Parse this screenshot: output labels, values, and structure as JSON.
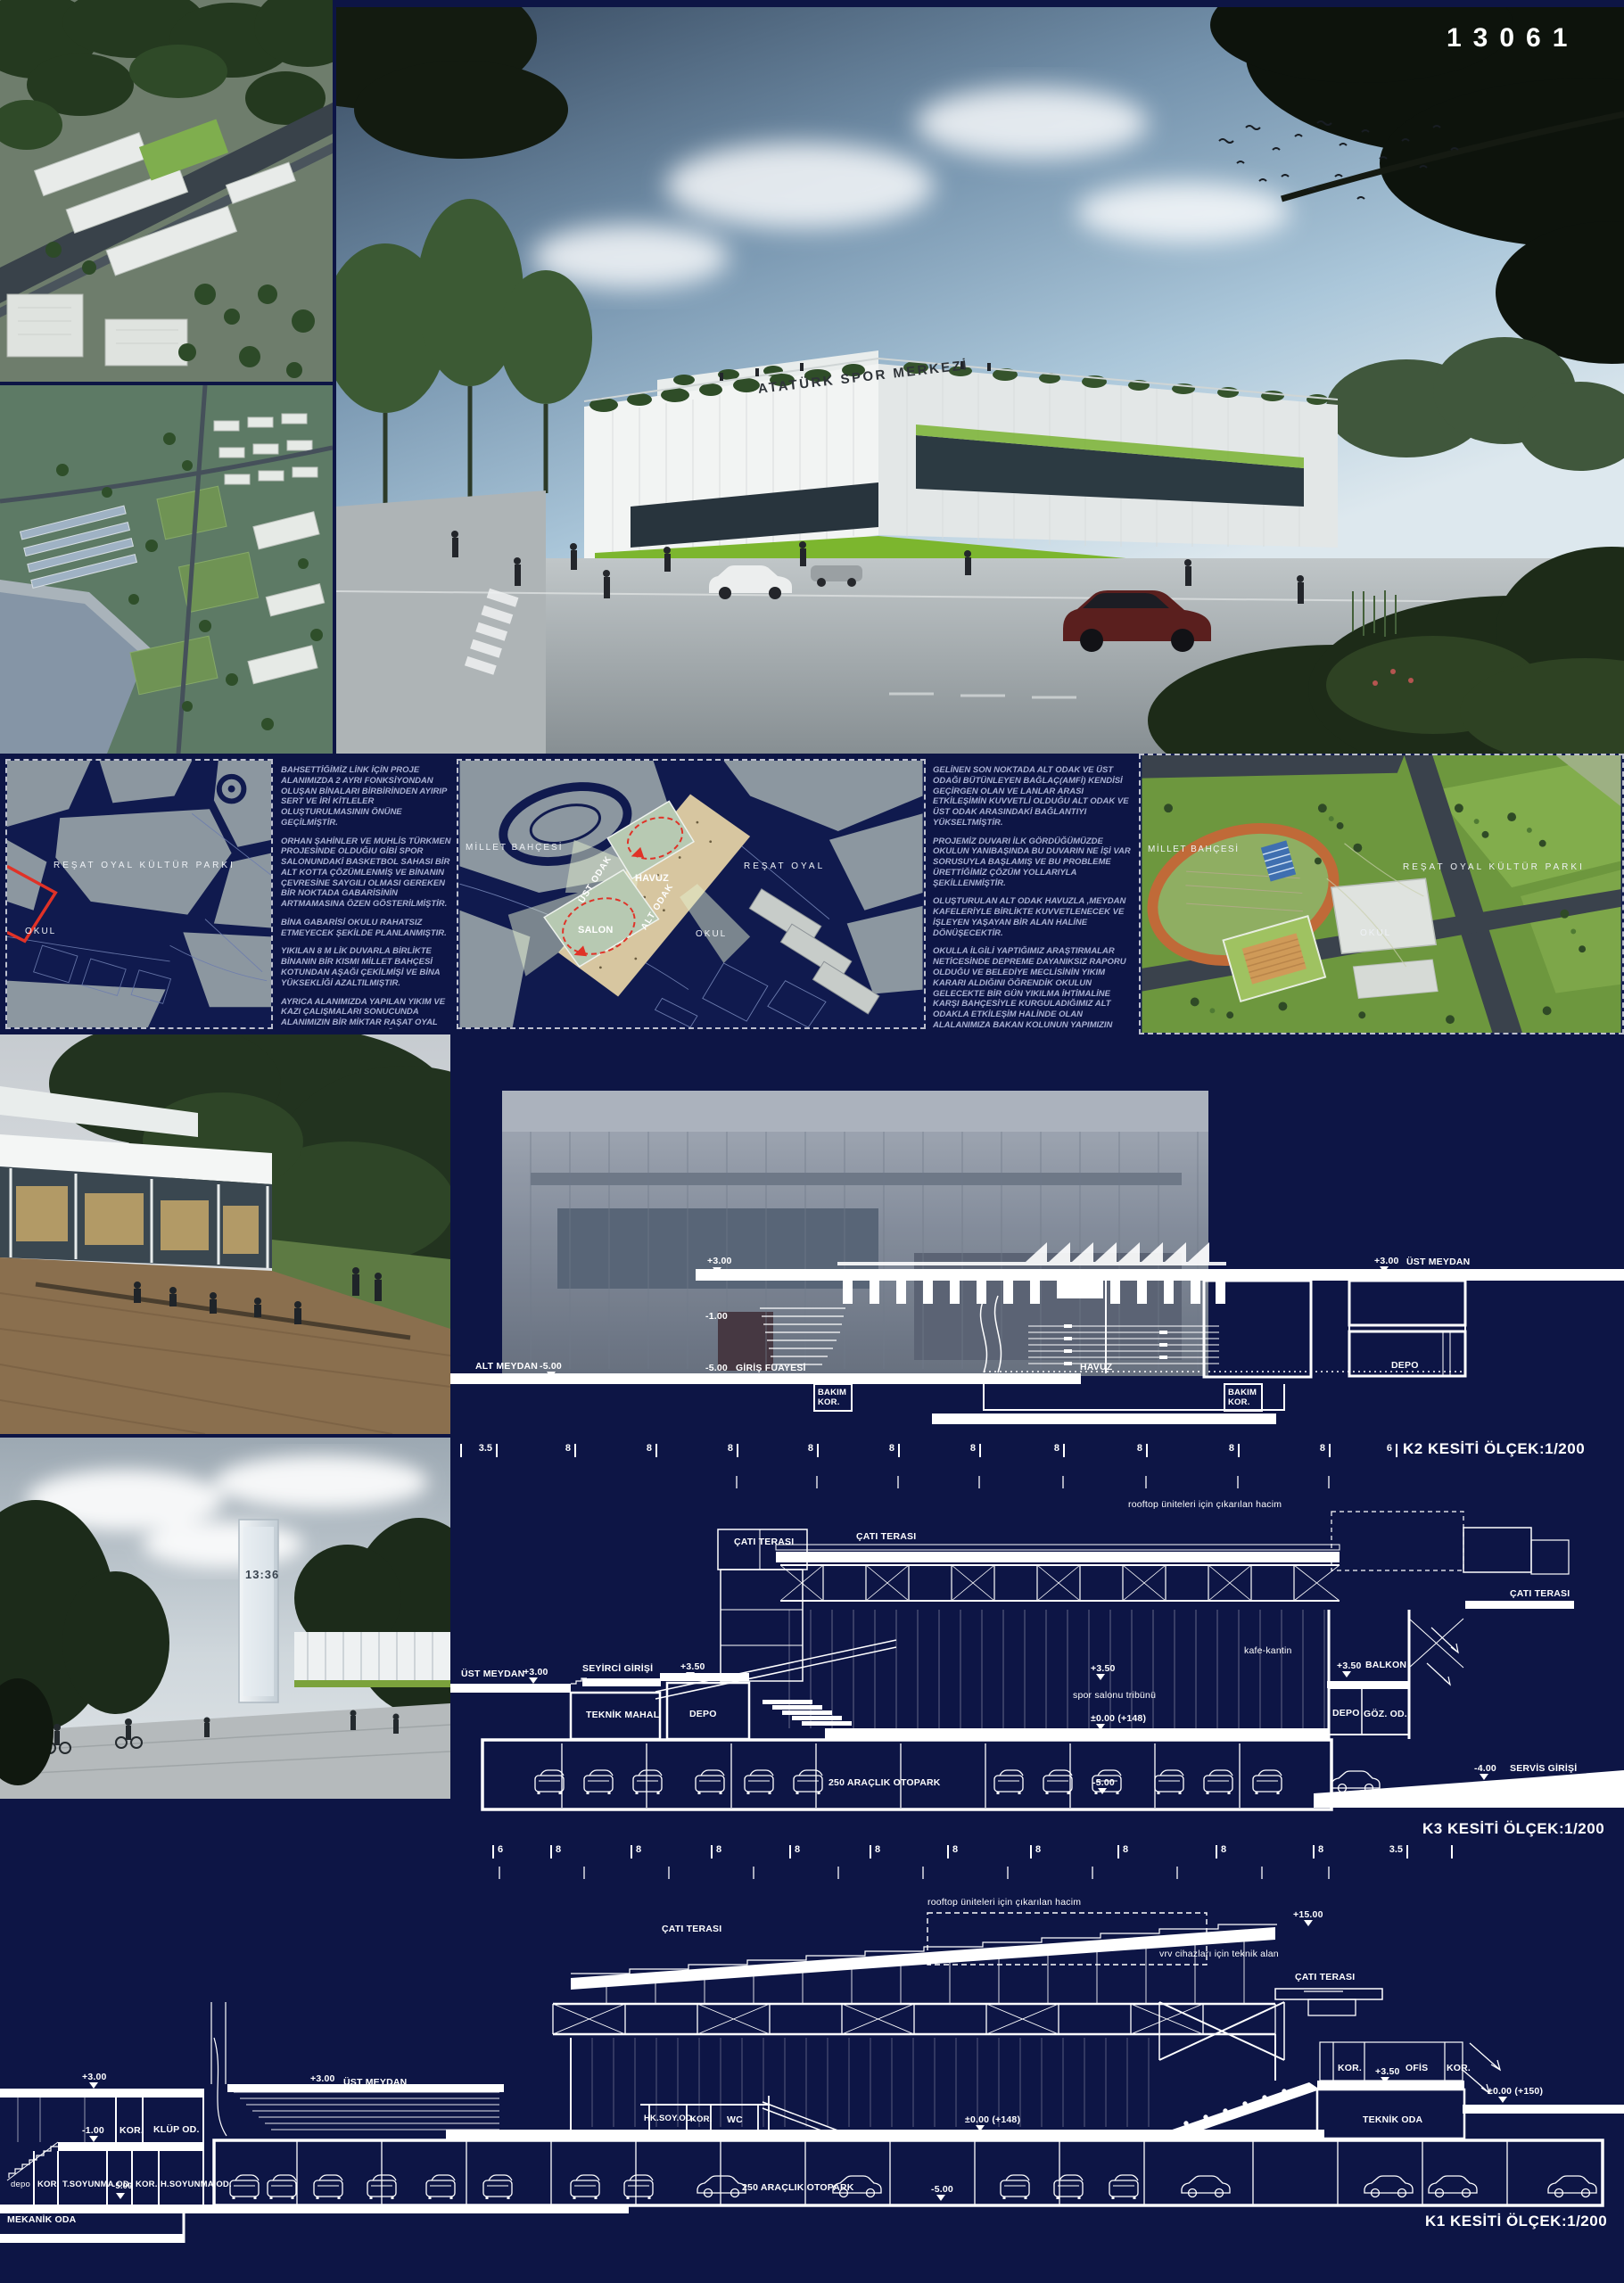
{
  "board": {
    "number": "13061"
  },
  "hero": {
    "building_sign": "ATATÜRK SPOR MERKEZİ"
  },
  "siteplan_left": {
    "park": "REŞAT OYAL KÜLTÜR PARKI",
    "school": "OKUL"
  },
  "siteplan_mid": {
    "millet": "MİLLET BAHÇESİ",
    "resat": "REŞAT OYAL",
    "school": "OKUL",
    "havuz": "HAVUZ",
    "salon": "SALON",
    "ust_odak": "ÜST ODAK",
    "alt_odak": "ALT ODAK"
  },
  "siteplan_right": {
    "millet": "MİLLET BAHÇESİ",
    "resat": "REŞAT OYAL KÜLTÜR PARKI",
    "school": "OKUL"
  },
  "text_left": {
    "p1": "BAHSETTİĞİMİZ LİNK İÇİN PROJE ALANIMIZDA 2 AYRI FONKSİYONDAN OLUŞAN BİNALARI BİRBİRİNDEN AYIRIP SERT VE İRİ KİTLELER OLUŞTURULMASININ ÖNÜNE GEÇİLMİŞTİR.",
    "p2": "ORHAN ŞAHİNLER VE MUHLİS TÜRKMEN PROJESİNDE OLDUĞIU GİBİ SPOR SALONUNDAKİ BASKETBOL SAHASI BİR ALT KOTTA ÇÖZÜMLENMİŞ VE BİNANIN ÇEVRESİNE SAYGILI OLMASI GEREKEN BİR NOKTADA GABARİSİNİN ARTMAMASINA ÖZEN GÖSTERİLMİŞTİR.",
    "p3": "BİNA GABARİSİ OKULU RAHATSIZ ETMEYECEK ŞEKİLDE PLANLANMIŞTIR.",
    "p4": "YIKILAN 8 M LİK DUVARLA BİRLİKTE BİNANIN BİR KISMI MİLLET BAHÇESİ KOTUNDAN AŞAĞI ÇEKİLMİŞİ VE BİNA YÜKSEKLİĞİ AZALTILMIŞTIR.",
    "p5": "AYRICA ALANIMIZDA YAPILAN YIKIM VE KAZI ÇALIŞMALARI SONUCUNDA ALANIMIZIN BİR MİKTAR RAŞAT OYAL PARK KOTUNA YAKLAŞTIĞI UNUTULMAMALIDIR."
  },
  "text_right": {
    "p1": "GELİNEN SON NOKTADA ALT ODAK VE ÜST ODAĞI BÜTÜNLEYEN BAĞLAÇ(AMFİ) KENDİSİ GEÇİRGEN OLAN VE LANLAR ARASI ETKİLEŞİMİN KUVVETLİ OLDUĞU ALT ODAK VE ÜST ODAK ARASINDAKİ BAĞLANTIYI YÜKSELTMİŞTİR.",
    "p2": "PROJEMİZ DUVARI İLK GÖRDÜĞÜMÜZDE OKULUN YANIBAŞINDA BU DUVARIN NE İŞİ VAR SORUSUYLA BAŞLAMIŞ VE BU PROBLEME ÜRETTİĞİMİZ ÇÖZÜM YOLLARIYLA ŞEKİLLENMİŞTİR.",
    "p3": "OLUŞTURULAN ALT ODAK HAVUZLA ,MEYDAN KAFELERİYLE BİRLİKTE KUVVETLENECEK VE İŞLEYEN YAŞAYAN BİR ALAN HALİNE DÖNÜŞECEKTİR.",
    "p4": "OKULLA İLGİLİ YAPTIĞIMIZ ARAŞTIRMALAR NETİCESİNDE DEPREME DAYANIKSIZ RAPORU OLDUĞU VE BELEDİYE MECLİSİNİN YIKIM KARARI ALDIĞINI ÖĞRENDİK OKULUN GELECEKTE BİR GÜN YIKILMA İHTİMALİNE KARŞI BAHÇESİYLE KURGULADIĞIMIZ ALT ODAKLA ETKİLEŞİM HALİNDE OLAN ALALANIMIZA BAKAN KOLUNUN YAPIMIZIN GENİŞLİĞİNİ GEÇMEMESİ GEREKTİĞİ DÜŞÜNCEMİZ MEVCUTTUR.BU PROJEYİ TASARLARKEN OKULUN ODAK ALAN İÇİNE GİRMESİ GEREKTİĞİNİ VE BERABER KURGULANMASINDAN OLUMLU SONUÇ ALINACAĞINI DÜŞÜNÜYORUZ"
  },
  "clock_render": {
    "time": "13:36"
  },
  "k2": {
    "title": "K2 KESİTİ ÖLÇEK:1/200",
    "plus3": "+3.00",
    "minus1": "-1.00",
    "alt_meydan": "ALT MEYDAN",
    "alt_level": "-5.00",
    "giris_level": "-5.00",
    "giris": "GİRİŞ FUAYESİ",
    "bakim": "BAKIM\nKOR.",
    "havuz": "HAVUZ",
    "bakim2": "BAKIM\nKOR.",
    "ust_level": "+3.00",
    "ust_meydan": "ÜST MEYDAN",
    "depo": "DEPO",
    "dims": [
      "3.5",
      "8",
      "8",
      "8",
      "8",
      "8",
      "8",
      "8",
      "8",
      "8",
      "8",
      "6"
    ]
  },
  "k3": {
    "title": "K3 KESİTİ ÖLÇEK:1/200",
    "cati1": "ÇATI TERASI",
    "cati2": "ÇATI TERASI",
    "cati3": "ÇATI TERASI",
    "rooftop": "rooftop üniteleri için çıkarılan hacim",
    "seyirci": "SEYİRCİ GİRİŞİ",
    "ust_meydan": "ÜST MEYDAN",
    "ust_level": "+3.00",
    "plus35a": "+3.50",
    "teknik": "TEKNİK MAHAL",
    "depo1": "DEPO",
    "kafe": "kafe-kantin",
    "plus35b": "+3.50",
    "spor": "spor salonu tribünü",
    "zero148": "±0.00 (+148)",
    "plus35c": "+3.50",
    "balkon": "BALKON",
    "depo2": "DEPO",
    "goz": "GÖZ. OD.",
    "otopark": "250 ARAÇLIK OTOPARK",
    "minus5": "-5.00",
    "servis_level": "-4.00",
    "servis": "SERVİS GİRİŞİ",
    "dims": [
      "6",
      "8",
      "8",
      "8",
      "8",
      "8",
      "8",
      "8",
      "8",
      "8",
      "8",
      "3.5"
    ]
  },
  "k1": {
    "title": "K1 KESİTİ ÖLÇEK:1/200",
    "rooftop": "rooftop üniteleri için çıkarılan hacim",
    "plus15": "+15.00",
    "vrv": "vrv cihazları için teknik alan",
    "cati_left": "ÇATI TERASI",
    "cati_right": "ÇATI TERASI",
    "plus3_left": "+3.00",
    "minus1": "-1.00",
    "kor": "KOR.",
    "klup": "KLÜP OD.",
    "depo_small": "depo",
    "kor2": "KOR.",
    "tsoyunma": "T.SOYUNMA OD.",
    "minus5a": "-5.00",
    "kor3": "KOR.",
    "hsoyunma": "H.SOYUNMA OD.",
    "mekanik": "MEKANİK ODA",
    "plus3_mid": "+3.00",
    "ust_meydan": "ÜST MEYDAN",
    "hksoy": "HK.SOY.OD.",
    "kor4": "KOR.",
    "wc": "WC",
    "zero148": "±0.00 (+148)",
    "otopark": "250 ARAÇLIK OTOPARK",
    "minus5b": "-5.00",
    "kor5": "KOR.",
    "plus35": "+3.50",
    "ofis": "OFİS",
    "kor6": "KOR.",
    "zero150": "±0.00 (+150)",
    "teknik_oda": "TEKNİK ODA"
  }
}
